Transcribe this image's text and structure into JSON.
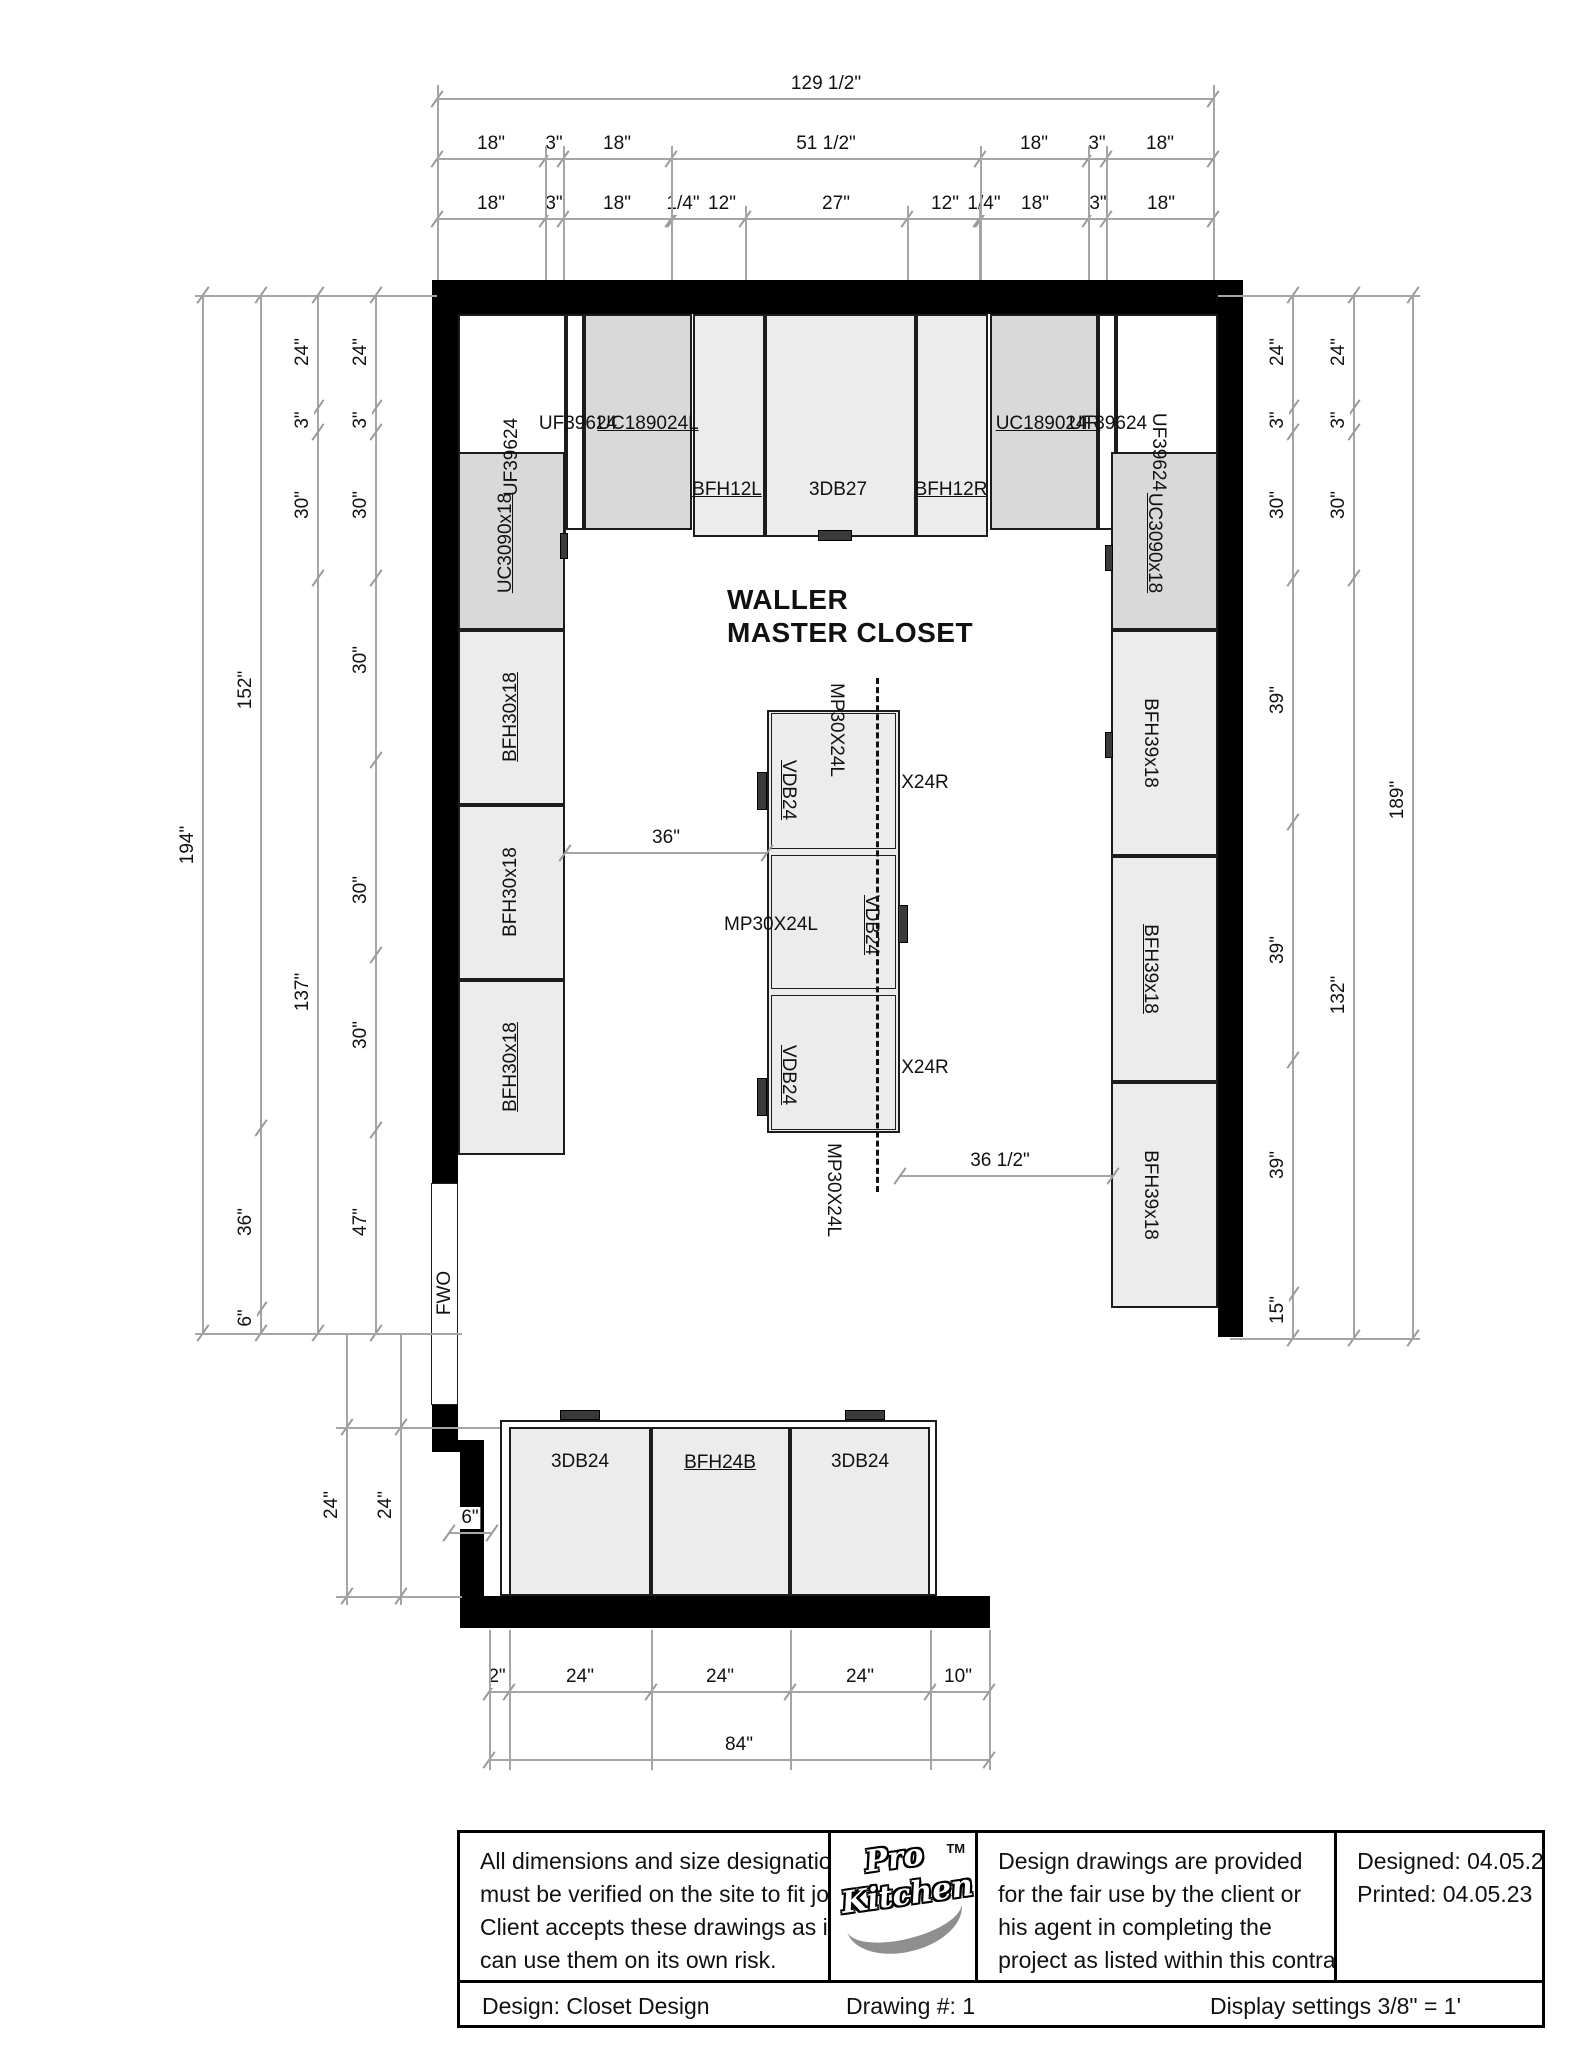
{
  "drawing": {
    "room_title": {
      "line1": "WALLER",
      "line2": "MASTER CLOSET"
    },
    "colors": {
      "wall": "#000000",
      "cabinet_gray": "#d9d9d9",
      "cabinet_light": "#ececec",
      "dim_line": "#a5a5a5",
      "text": "#111111"
    },
    "walls": [
      [
        432,
        280,
        811,
        34
      ],
      [
        432,
        280,
        26,
        903
      ],
      [
        1218,
        280,
        25,
        1057
      ],
      [
        432,
        1405,
        26,
        47
      ],
      [
        432,
        1440,
        52,
        12
      ],
      [
        460,
        1447,
        24,
        181
      ],
      [
        460,
        1596,
        530,
        32
      ]
    ],
    "cabinets": [
      {
        "x": 458,
        "y": 314,
        "w": 108,
        "h": 223,
        "fill": "white",
        "name": "corner-cabinet-left"
      },
      {
        "x": 566,
        "y": 314,
        "w": 18,
        "h": 216,
        "fill": "white",
        "name": "filler-left"
      },
      {
        "x": 584,
        "y": 314,
        "w": 108,
        "h": 216,
        "fill": "gray",
        "name": "cabinet-UC189024L"
      },
      {
        "x": 693,
        "y": 314,
        "w": 72,
        "h": 223,
        "fill": "light",
        "name": "cabinet-BFH12L"
      },
      {
        "x": 765,
        "y": 314,
        "w": 151,
        "h": 223,
        "fill": "light",
        "name": "cabinet-3DB27"
      },
      {
        "x": 916,
        "y": 314,
        "w": 72,
        "h": 223,
        "fill": "light",
        "name": "cabinet-BFH12R"
      },
      {
        "x": 990,
        "y": 314,
        "w": 108,
        "h": 216,
        "fill": "gray",
        "name": "cabinet-UC189024R"
      },
      {
        "x": 1098,
        "y": 314,
        "w": 18,
        "h": 216,
        "fill": "white",
        "name": "filler-right"
      },
      {
        "x": 1116,
        "y": 314,
        "w": 102,
        "h": 223,
        "fill": "white",
        "name": "corner-cabinet-right"
      },
      {
        "x": 458,
        "y": 452,
        "w": 107,
        "h": 178,
        "fill": "gray",
        "name": "cabinet-UC3090x18-left"
      },
      {
        "x": 458,
        "y": 630,
        "w": 107,
        "h": 175,
        "fill": "light",
        "name": "cabinet-BFH30x18-1"
      },
      {
        "x": 458,
        "y": 805,
        "w": 107,
        "h": 175,
        "fill": "light",
        "name": "cabinet-BFH30x18-2"
      },
      {
        "x": 458,
        "y": 980,
        "w": 107,
        "h": 175,
        "fill": "light",
        "name": "cabinet-BFH30x18-3"
      },
      {
        "x": 1111,
        "y": 452,
        "w": 107,
        "h": 178,
        "fill": "gray",
        "name": "cabinet-UC3090x18-right"
      },
      {
        "x": 1111,
        "y": 630,
        "w": 107,
        "h": 226,
        "fill": "light",
        "name": "cabinet-BFH39x18-1"
      },
      {
        "x": 1111,
        "y": 856,
        "w": 107,
        "h": 226,
        "fill": "light",
        "name": "cabinet-BFH39x18-2"
      },
      {
        "x": 1111,
        "y": 1082,
        "w": 107,
        "h": 226,
        "fill": "light",
        "name": "cabinet-BFH39x18-3"
      },
      {
        "x": 500,
        "y": 1420,
        "w": 437,
        "h": 176,
        "fill": "white",
        "name": "bottom-run-outline"
      },
      {
        "x": 509,
        "y": 1427,
        "w": 142,
        "h": 169,
        "fill": "light",
        "name": "cabinet-3DB24-left"
      },
      {
        "x": 651,
        "y": 1427,
        "w": 139,
        "h": 169,
        "fill": "light",
        "name": "cabinet-BFH24B"
      },
      {
        "x": 790,
        "y": 1427,
        "w": 140,
        "h": 169,
        "fill": "light",
        "name": "cabinet-3DB24-right"
      },
      {
        "x": 431,
        "y": 1183,
        "w": 27,
        "h": 222,
        "fill": "white",
        "name": "fwo-opening"
      }
    ],
    "island": {
      "x": 767,
      "y": 710,
      "w": 133,
      "h": 423,
      "sections": [
        [
          710,
          142
        ],
        [
          852,
          140
        ],
        [
          992,
          141
        ]
      ]
    },
    "handles": [
      [
        818,
        530,
        34,
        11
      ],
      [
        560,
        1410,
        40,
        10
      ],
      [
        845,
        1410,
        40,
        10
      ],
      [
        757,
        772,
        10,
        38
      ],
      [
        757,
        1078,
        10,
        38
      ],
      [
        898,
        905,
        10,
        38
      ],
      [
        560,
        533,
        8,
        26
      ],
      [
        1105,
        545,
        8,
        26
      ],
      [
        1105,
        732,
        8,
        26
      ]
    ],
    "dashed_lines": [
      [
        876,
        678,
        1192
      ]
    ],
    "labels": [
      [
        "UF39624",
        578,
        424,
        "h",
        false
      ],
      [
        "UC189024L",
        648,
        424,
        "h",
        true
      ],
      [
        "UC189024R",
        1048,
        424,
        "h",
        true
      ],
      [
        "UF39624",
        1108,
        424,
        "h",
        false
      ],
      [
        "BFH12L",
        727,
        490,
        "h",
        true
      ],
      [
        "3DB27",
        838,
        490,
        "h",
        false
      ],
      [
        "BFH12R",
        951,
        490,
        "h",
        true
      ],
      [
        "UF39624",
        512,
        457,
        "ccw",
        false
      ],
      [
        "UC3090x18",
        506,
        543,
        "ccw",
        true
      ],
      [
        "BFH30x18",
        511,
        717,
        "ccw",
        true
      ],
      [
        "BFH30x18",
        511,
        892,
        "ccw",
        false
      ],
      [
        "BFH30x18",
        511,
        1067,
        "ccw",
        true
      ],
      [
        "UF39624",
        1158,
        452,
        "cw",
        false
      ],
      [
        "UC3090x18",
        1154,
        543,
        "cw",
        true
      ],
      [
        "BFH39x18",
        1150,
        743,
        "cw",
        false
      ],
      [
        "BFH39x18",
        1150,
        969,
        "cw",
        true
      ],
      [
        "BFH39x18",
        1150,
        1195,
        "cw",
        false
      ],
      [
        "MP30X24L",
        836,
        730,
        "cw",
        false
      ],
      [
        "VDB24",
        788,
        790,
        "cw",
        true
      ],
      [
        "X24R",
        925,
        783,
        "h",
        false
      ],
      [
        "MP30X24L",
        771,
        925,
        "h",
        false
      ],
      [
        "VDB24",
        871,
        925,
        "cw",
        true
      ],
      [
        "VDB24",
        788,
        1075,
        "cw",
        true
      ],
      [
        "X24R",
        925,
        1068,
        "h",
        false
      ],
      [
        "MP30X24L",
        833,
        1190,
        "cw",
        false
      ],
      [
        "3DB24",
        580,
        1462,
        "h",
        false
      ],
      [
        "BFH24B",
        720,
        1463,
        "h",
        true
      ],
      [
        "3DB24",
        860,
        1462,
        "h",
        false
      ],
      [
        "FWO",
        445,
        1293,
        "ccw",
        false
      ]
    ],
    "h_dims": [
      {
        "y": 98,
        "b": [
          437,
          1213
        ],
        "labels": [
          [
            "129 1/2\"",
            826
          ]
        ]
      },
      {
        "y": 158,
        "b": [
          437,
          545,
          563,
          671,
          980,
          1088,
          1106,
          1213
        ],
        "labels": [
          [
            "18\"",
            491
          ],
          [
            "3\"",
            554
          ],
          [
            "18\"",
            617
          ],
          [
            "51 1/2\"",
            826
          ],
          [
            "18\"",
            1034
          ],
          [
            "3\"",
            1097
          ],
          [
            "18\"",
            1160
          ]
        ]
      },
      {
        "y": 218,
        "b": [
          437,
          545,
          563,
          671,
          673,
          745,
          907,
          979,
          981,
          1088,
          1106,
          1213
        ],
        "labels": [
          [
            "18\"",
            491
          ],
          [
            "3\"",
            554
          ],
          [
            "18\"",
            617
          ],
          [
            "1/4\"",
            683
          ],
          [
            "12\"",
            722
          ],
          [
            "27\"",
            836
          ],
          [
            "12\"",
            945
          ],
          [
            "1/4\"",
            984
          ],
          [
            "18\"",
            1035
          ],
          [
            "3\"",
            1098
          ],
          [
            "18\"",
            1161
          ]
        ]
      },
      {
        "y": 852,
        "b": [
          565,
          767
        ],
        "labels": [
          [
            "36\"",
            666
          ]
        ]
      },
      {
        "y": 1175,
        "b": [
          900,
          1113
        ],
        "labels": [
          [
            "36 1/2\"",
            1000
          ]
        ]
      },
      {
        "y": 1532,
        "b": [
          449,
          492
        ],
        "labels": [
          [
            "6\"",
            470
          ]
        ]
      },
      {
        "y": 1691,
        "b": [
          489,
          509,
          651,
          790,
          930,
          989
        ],
        "labels": [
          [
            "2\"",
            497
          ],
          [
            "24\"",
            580
          ],
          [
            "24\"",
            720
          ],
          [
            "24\"",
            860
          ],
          [
            "10\"",
            958
          ]
        ]
      },
      {
        "y": 1759,
        "b": [
          489,
          989
        ],
        "labels": [
          [
            "84\"",
            739
          ]
        ]
      }
    ],
    "v_dims": [
      {
        "x": 202,
        "b": [
          295,
          1333
        ],
        "labels": [
          [
            "194\"",
            845
          ]
        ]
      },
      {
        "x": 260,
        "b": [
          295,
          1128,
          1310,
          1333
        ],
        "labels": [
          [
            "152\"",
            690
          ],
          [
            "36\"",
            1222
          ],
          [
            "6\"",
            1318
          ]
        ]
      },
      {
        "x": 317,
        "b": [
          295,
          408,
          432,
          578,
          1333
        ],
        "labels": [
          [
            "24\"",
            352
          ],
          [
            "3\"",
            420
          ],
          [
            "30\"",
            505
          ],
          [
            "137\"",
            992
          ]
        ]
      },
      {
        "x": 375,
        "b": [
          295,
          408,
          432,
          578,
          760,
          955,
          1130,
          1333
        ],
        "labels": [
          [
            "24\"",
            352
          ],
          [
            "3\"",
            420
          ],
          [
            "30\"",
            505
          ],
          [
            "30\"",
            660
          ],
          [
            "30\"",
            890
          ],
          [
            "30\"",
            1035
          ],
          [
            "47\"",
            1222
          ]
        ]
      },
      {
        "x": 1292,
        "b": [
          295,
          408,
          432,
          578,
          822,
          1060,
          1295,
          1338
        ],
        "labels": [
          [
            "24\"",
            352
          ],
          [
            "3\"",
            420
          ],
          [
            "30\"",
            505
          ],
          [
            "39\"",
            700
          ],
          [
            "39\"",
            950
          ],
          [
            "39\"",
            1165
          ],
          [
            "15\"",
            1310
          ]
        ]
      },
      {
        "x": 1353,
        "b": [
          295,
          408,
          432,
          578,
          1338
        ],
        "labels": [
          [
            "24\"",
            352
          ],
          [
            "3\"",
            420
          ],
          [
            "30\"",
            505
          ],
          [
            "132\"",
            995
          ]
        ]
      },
      {
        "x": 1412,
        "b": [
          295,
          1338
        ],
        "labels": [
          [
            "189\"",
            800
          ]
        ]
      },
      {
        "x": 346,
        "b": [
          1427,
          1596
        ],
        "span": [
          1333,
          1605
        ],
        "labels": [
          [
            "24\"",
            1505
          ]
        ]
      },
      {
        "x": 400,
        "b": [
          1427,
          1596
        ],
        "span": [
          1333,
          1605
        ],
        "labels": [
          [
            "24\"",
            1505
          ]
        ]
      }
    ],
    "ext_v": [
      [
        437,
        85,
        280
      ],
      [
        1213,
        85,
        280
      ],
      [
        545,
        146,
        280
      ],
      [
        563,
        146,
        280
      ],
      [
        671,
        146,
        280
      ],
      [
        980,
        146,
        280
      ],
      [
        1088,
        146,
        280
      ],
      [
        1106,
        146,
        280
      ],
      [
        745,
        206,
        280
      ],
      [
        907,
        206,
        280
      ],
      [
        979,
        206,
        280
      ],
      [
        489,
        1630,
        1770
      ],
      [
        509,
        1630,
        1770
      ],
      [
        651,
        1630,
        1770
      ],
      [
        790,
        1630,
        1770
      ],
      [
        930,
        1630,
        1770
      ],
      [
        989,
        1630,
        1770
      ]
    ],
    "ext_h": [
      [
        295,
        195,
        437
      ],
      [
        1333,
        195,
        462
      ],
      [
        295,
        1218,
        1420
      ],
      [
        1338,
        1230,
        1420
      ],
      [
        1427,
        336,
        500
      ],
      [
        1596,
        336,
        462
      ]
    ]
  },
  "title_block": {
    "disclaimer_lines": [
      "All dimensions and size designations",
      "must be verified on the site to fit job",
      "Client accepts these drawings as is a",
      "can use them on its own risk."
    ],
    "logo": {
      "line1": "Pro",
      "line2": "Kitchen",
      "tm": "TM"
    },
    "provision_lines": [
      "Design drawings are provided",
      "for the fair use by the client or",
      "his agent in completing the",
      "project as listed within this contract"
    ],
    "designed": "Designed: 04.05.2",
    "printed": "Printed: 04.05.23",
    "design_label": "Design: Closet Design",
    "drawing_number": "Drawing #: 1",
    "display_settings": "Display settings 3/8\" = 1'"
  }
}
